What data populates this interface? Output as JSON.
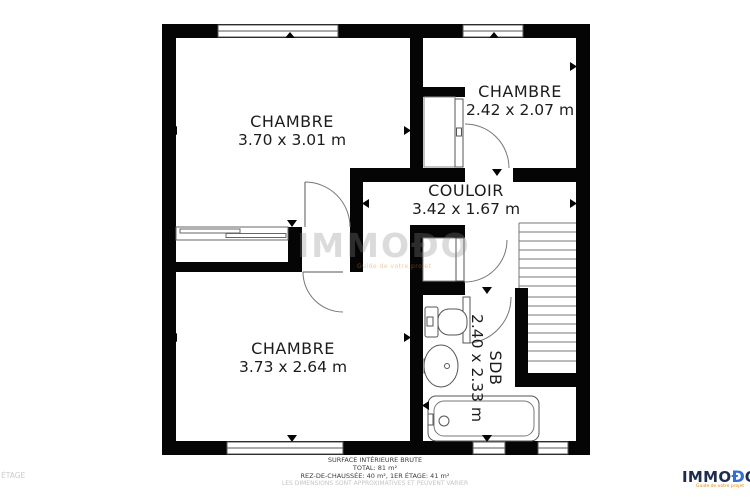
{
  "plan": {
    "floor_label": "ÉTAGE",
    "watermark": {
      "text": "IMMOĐO",
      "tagline": "Guide de votre projet"
    },
    "rooms": [
      {
        "name": "CHAMBRE",
        "dims": "3.70 x 3.01 m"
      },
      {
        "name": "CHAMBRE",
        "dims": "2.42 x 2.07 m"
      },
      {
        "name": "COULOIR",
        "dims": "3.42 x 1.67 m"
      },
      {
        "name": "CHAMBRE",
        "dims": "3.73 x 2.64 m"
      },
      {
        "name": "SDB",
        "dims": "2.40 x 2.33 m"
      }
    ],
    "summary": {
      "line1": "SURFACE INTÉRIEURE BRUTE",
      "line2": "TOTAL: 81 m²",
      "line3": "REZ-DE-CHAUSSÉE: 40 m², 1ER ÉTAGE: 41 m²",
      "line4": "LES DIMENSIONS SONT APPROXIMATIVES ET PEUVENT VARIER"
    },
    "logo": {
      "text_dark": "IMMO",
      "text_accent": "Đ",
      "text_dark2": "OT",
      "tagline": "Guide de votre projet",
      "color_dark": "#1e2c4e",
      "color_accent": "#2f6fd6",
      "wall_color": "#050505"
    }
  }
}
